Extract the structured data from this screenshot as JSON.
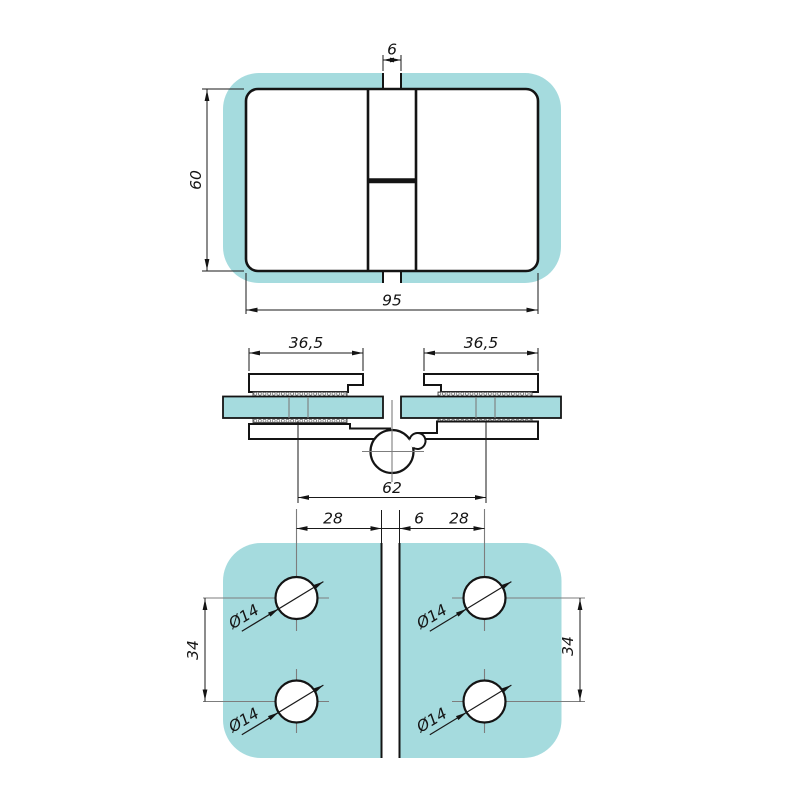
{
  "colors": {
    "glass": "#a5dbde",
    "line": "#141414",
    "centerline": "#7d7d7d"
  },
  "front_view": {
    "dim_gap_top": "6",
    "dim_height": "60",
    "dim_width": "95"
  },
  "section_view": {
    "dim_plate_left": "36,5",
    "dim_plate_right": "36,5",
    "dim_hole_span": "62"
  },
  "back_view": {
    "dim_hole_offset_left": "28",
    "dim_gap": "6",
    "dim_hole_offset_right": "28",
    "dim_hole_pitch_left": "34",
    "dim_hole_pitch_right": "34",
    "hole_diameter": "Ø14"
  }
}
